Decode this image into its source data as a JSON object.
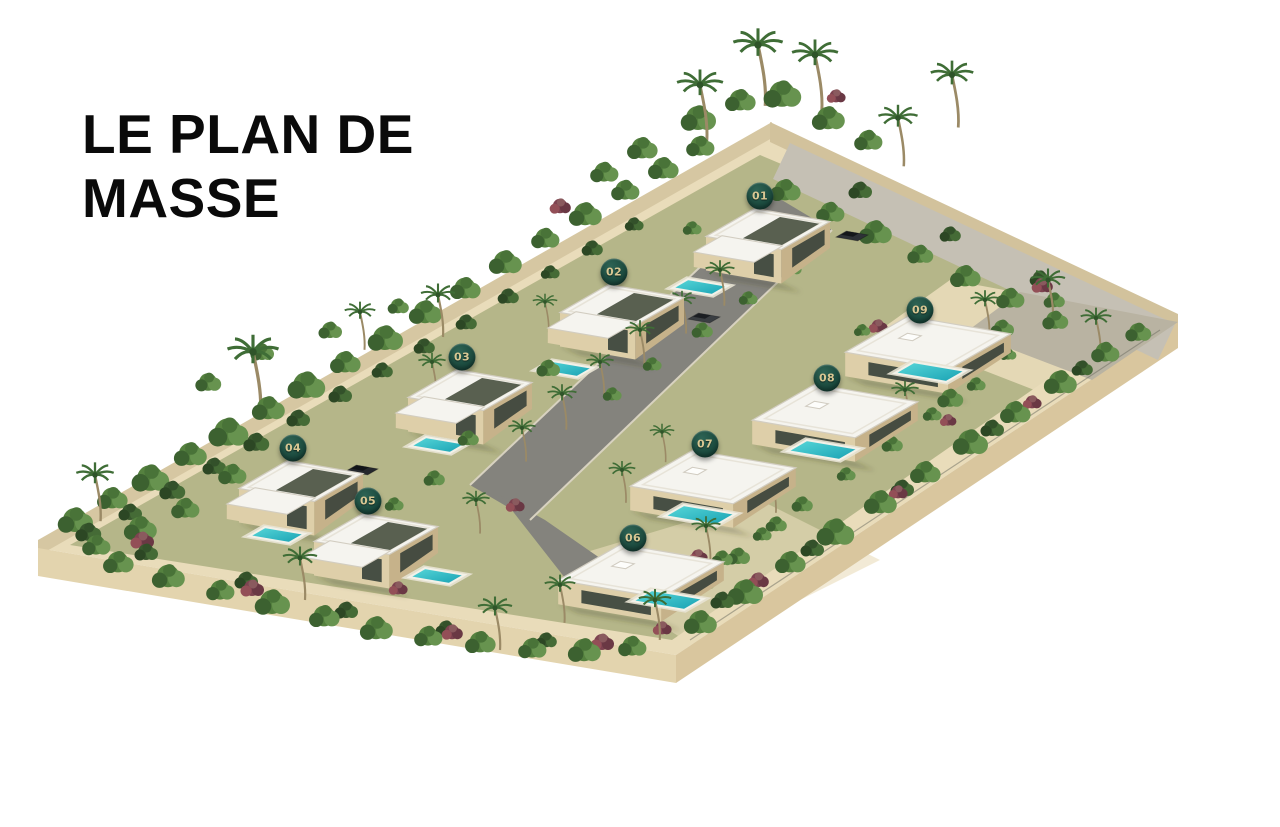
{
  "title": {
    "line1": "LE PLAN DE",
    "line2": "MASSE"
  },
  "plan": {
    "label": "site-master-plan",
    "villas": [
      {
        "number": "01",
        "x": 760,
        "y": 196,
        "floors": 2
      },
      {
        "number": "02",
        "x": 614,
        "y": 272,
        "floors": 2
      },
      {
        "number": "03",
        "x": 462,
        "y": 357,
        "floors": 2
      },
      {
        "number": "04",
        "x": 293,
        "y": 448,
        "floors": 2
      },
      {
        "number": "05",
        "x": 368,
        "y": 501,
        "floors": 2
      },
      {
        "number": "06",
        "x": 633,
        "y": 538,
        "floors": 1
      },
      {
        "number": "07",
        "x": 705,
        "y": 444,
        "floors": 1
      },
      {
        "number": "08",
        "x": 827,
        "y": 378,
        "floors": 1
      },
      {
        "number": "09",
        "x": 920,
        "y": 310,
        "floors": 1
      }
    ]
  },
  "colors": {
    "badge_bg": "#1b4a3e",
    "badge_hi": "#2e6354",
    "badge_text": "#d8c793",
    "ground": "#e9dcba",
    "lawn": "#8a9760",
    "road": "#84837d",
    "roof": "#f5f4ef",
    "roof_edge": "#d2cdc1",
    "wall_light": "#decfa9",
    "wall_shade": "#c6b28a",
    "glass": "#323d36",
    "pergola": "#4b5342",
    "pool_light": "#5ad9da",
    "pool_dark": "#17a0b2"
  }
}
